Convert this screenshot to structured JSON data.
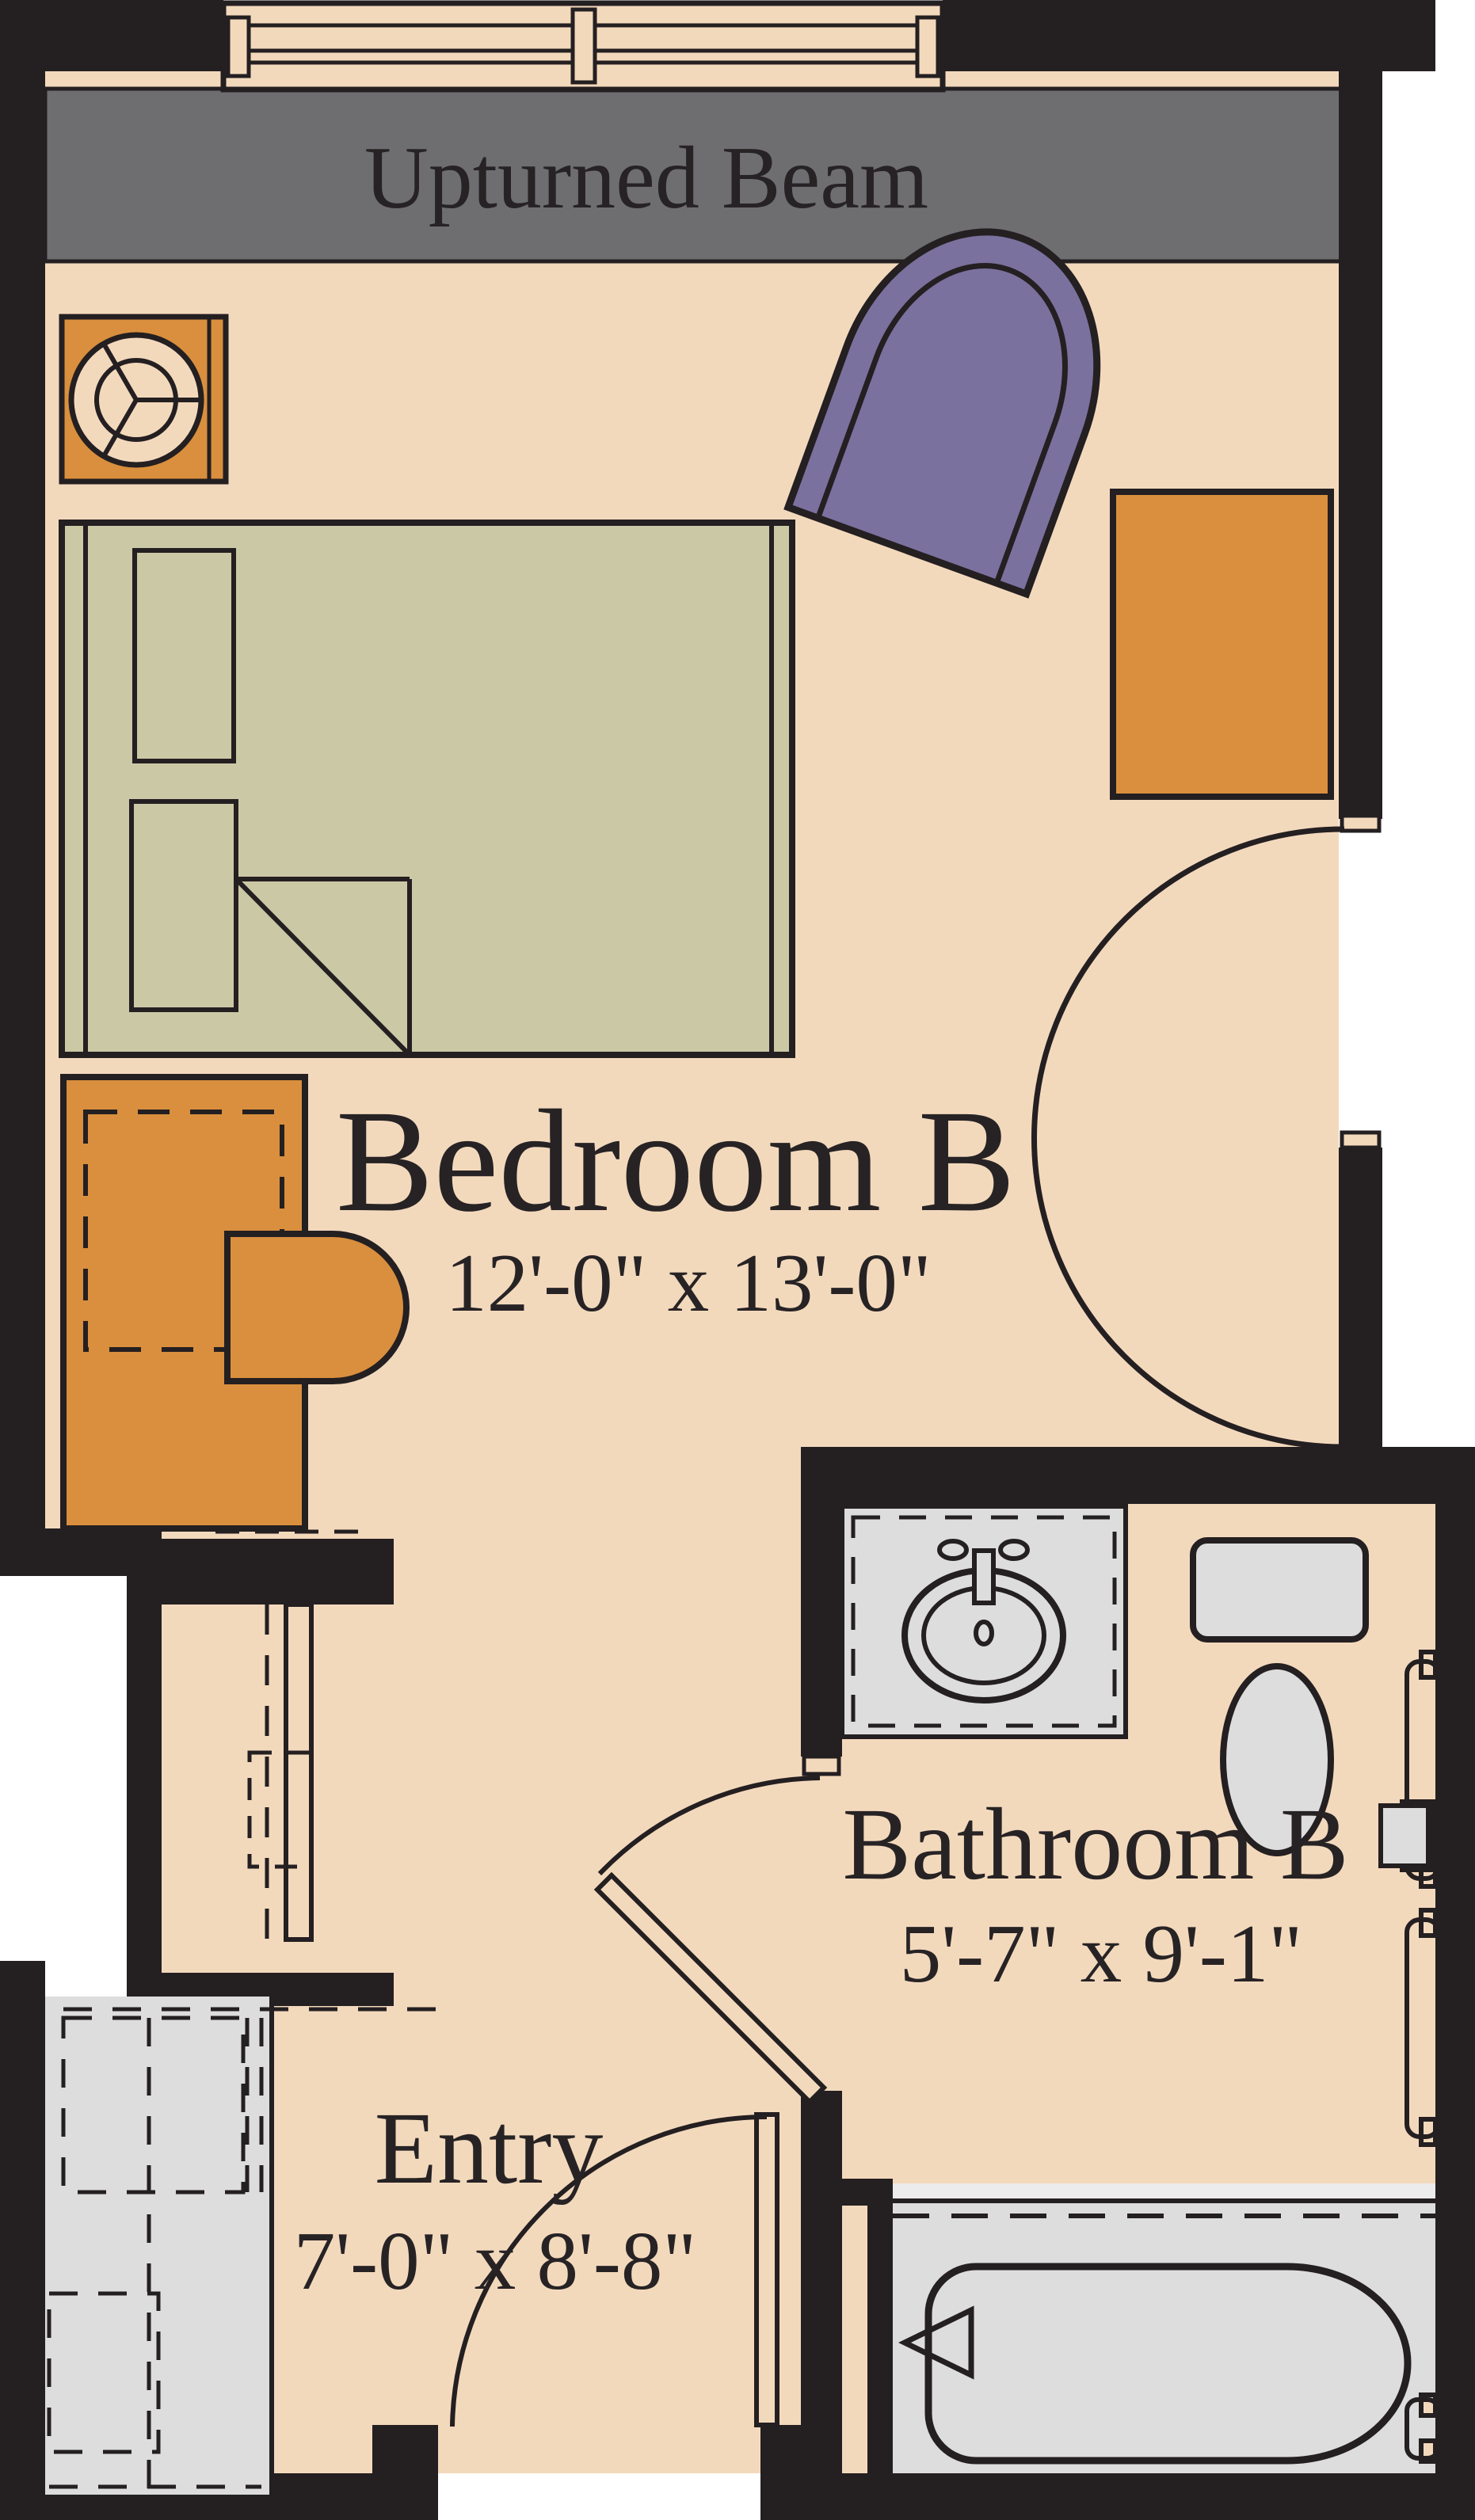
{
  "beam": {
    "label": "Upturned Beam"
  },
  "rooms": {
    "bedroom": {
      "name": "Bedroom B",
      "dimensions": "12'-0\" x 13'-0\""
    },
    "bathroom": {
      "name": "Bathroom B",
      "dimensions": "5'-7\" x 9'-1\""
    },
    "entry": {
      "name": "Entry",
      "dimensions": "7'-0\" x 8'-8\""
    }
  },
  "palette": {
    "wall_black": "#241f21",
    "floor_peach": "#f3d9bc",
    "beam_gray": "#6e6e71",
    "bed_olive": "#cbc8a5",
    "accent_orange": "#d98f3d",
    "accent_purple": "#7b719e",
    "fixture_gray": "#dddddd",
    "outside_white": "#ffffff"
  },
  "fixtures": [
    "window-icon",
    "bed-icon",
    "pillow-icon",
    "fan-table-icon",
    "armchair-icon",
    "dresser-icon",
    "desk-icon",
    "desk-chair-icon",
    "door-swing-icon",
    "pocket-door-icon",
    "vanity-sink-icon",
    "toilet-icon",
    "grab-bar-icon",
    "toilet-paper-holder-icon",
    "bathtub-icon",
    "shower-curtain-icon",
    "closet-icon"
  ]
}
